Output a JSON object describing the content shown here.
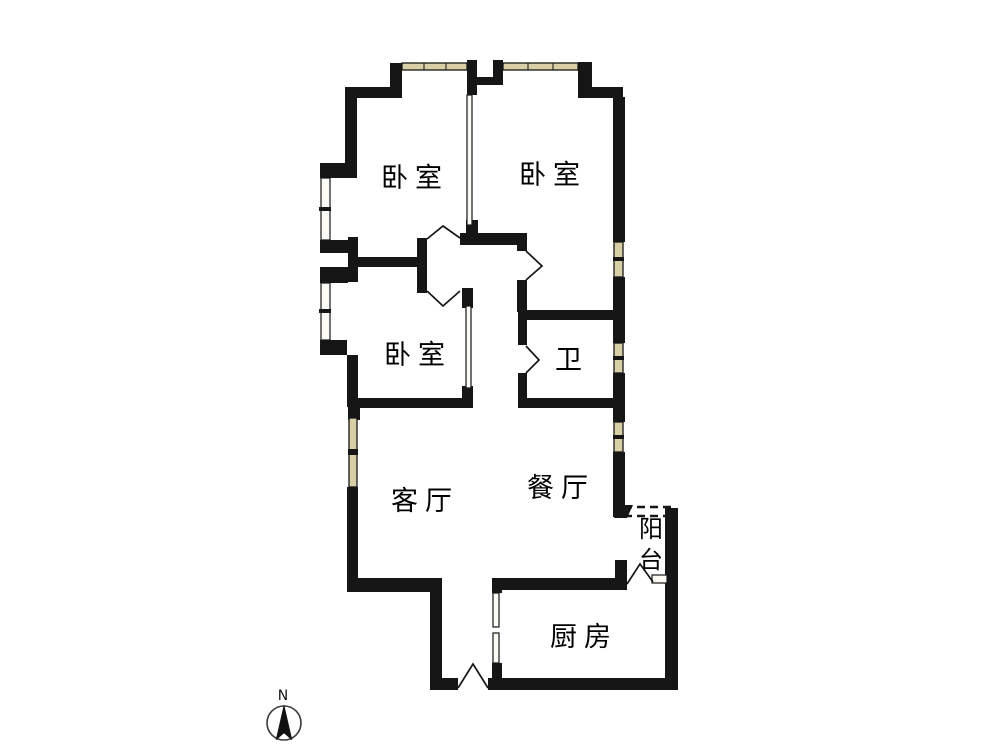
{
  "meta": {
    "description": "Residential apartment floor plan, 3 bedrooms, black wall outlines on white background"
  },
  "rooms": {
    "bedroom_top_left": {
      "label": "卧室"
    },
    "bedroom_top_right": {
      "label": "卧室"
    },
    "bedroom_middle": {
      "label": "卧室"
    },
    "bathroom": {
      "label": "卫"
    },
    "living_room": {
      "label": "客厅"
    },
    "dining_room": {
      "label": "餐厅"
    },
    "kitchen": {
      "label": "厨房"
    },
    "balcony": {
      "label": "阳台",
      "chars": [
        "阳",
        "台"
      ]
    }
  },
  "compass": {
    "north_label": "N"
  },
  "colors": {
    "wall": "#161616",
    "window_fill": "#d8cfa6",
    "background": "#ffffff"
  }
}
